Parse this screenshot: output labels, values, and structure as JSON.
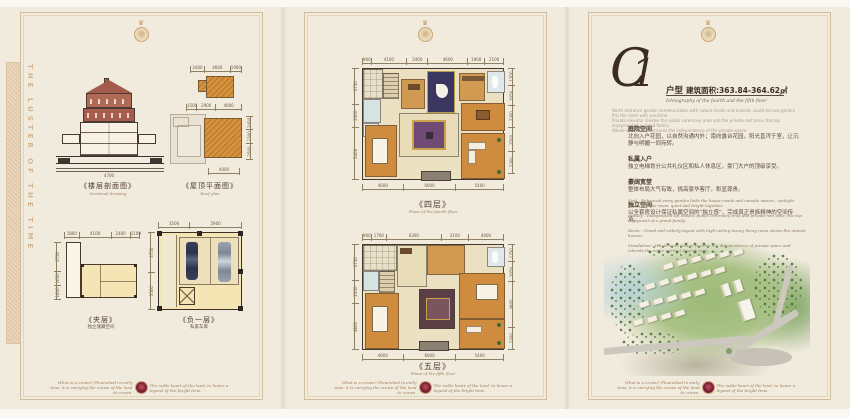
{
  "page": {
    "bg": "#f1ebde",
    "frame_color": "#cfbd9e",
    "seal_color": "#7c1f30",
    "accent_gold": "#c09a66"
  },
  "side_text": "THE LUSTER OF THE TIME",
  "crest": {
    "icon": "crown-icon",
    "glyph": "♛"
  },
  "footer": {
    "left": "What is a crown? Flourished in early time, it is carrying the crown of the land to crown.",
    "right": "The noble heart of the land, to honor a legend of the bright time."
  },
  "left": {
    "section": {
      "label": "《楼层剖面图》",
      "sub": "Sectional drawing",
      "dim_bottom": "4700"
    },
    "roof": {
      "label": "《屋顶平面图》",
      "sub": "Roof plan",
      "dims_top": [
        "2400",
        "4600",
        "1900"
      ],
      "dims_mid": [
        "1500",
        "2900",
        "4000"
      ],
      "dims_right": [
        "2050",
        "2300",
        "2500"
      ],
      "dims_bottom": [
        "4000"
      ]
    },
    "mezzanine": {
      "label": "《夹层》",
      "sub": "独立储藏空间",
      "dims_top": [
        "1800",
        "4100",
        "2400",
        "1100"
      ],
      "dims_left": [
        "3750",
        "1650",
        "1800"
      ]
    },
    "basement": {
      "label": "《负一层》",
      "sub": "私家车库",
      "dims_top": [
        "3500",
        "5900"
      ],
      "dims_left": [
        "3750",
        "3500"
      ]
    }
  },
  "middle": {
    "floor4": {
      "label": "《四层》",
      "sub": "Plane of the fourth floor",
      "dims_top": [
        "900",
        "4100",
        "2400",
        "4600",
        "1900",
        "2100"
      ],
      "dims_left": [
        "3750",
        "2300",
        "5400"
      ],
      "dims_right": [
        "1700",
        "2050",
        "2300",
        "2500",
        "2300"
      ],
      "dims_bottom": [
        "4600",
        "6000",
        "5400"
      ]
    },
    "floor5": {
      "label": "《五层》",
      "sub": "Plane of the fifth floor",
      "dims_top": [
        "900",
        "1700",
        "6300",
        "3100",
        "4000"
      ],
      "dims_left": [
        "3750",
        "2300",
        "4800"
      ],
      "dims_right": [
        "1750",
        "2050",
        "4800",
        "2300"
      ],
      "dims_bottom": [
        "4600",
        "6000",
        "5400"
      ]
    }
  },
  "right": {
    "logo": "C1",
    "logo_c": "C",
    "logo_one": "1",
    "type_label": "户型",
    "area": "建筑面积:363.84-364.62㎡",
    "subtitle": "Ichnography of the fourth and the fifth floor",
    "fine_print": [
      "North entrance garden communicates with nature inside and outside, south terrace garden fills the room with sunshine.",
      "Private elevator divides the public ceremony area and the private rest area, the top enjoyment of a grand family.",
      "Whole-suite design ensures the independence of the private space."
    ],
    "paragraphs": [
      {
        "head": "庭院空间",
        "body": "北向入户花园，以自然沟通内外；南向露台花园，阳光直泻于室，让沉静与明媚一同宛转。"
      },
      {
        "head": "私属入户",
        "body": "独立电梯划分公共礼仪区和私人休息区，豪门大户的顶级享受。"
      },
      {
        "head": "豪阔宽堂",
        "body": "整体布局大气有致，挑高豪华客厅，彰显尊贵。"
      },
      {
        "head": "独立空间",
        "body": "以全套房设计保证私属空间的“独立感”，完成真正贵族精神的空间传承。"
      }
    ],
    "en_lines": [
      "Yard : Enhanced entry garden links the house inside and outside nature ; sunlight pours into the room, quiet and bright together.",
      "Privacy : Independent lift divides public ceremony area and private rest zone, the top enjoyment of a grand family.",
      "Room : Grand and orderly layout with high-ceiling luxury living room shows the utmost honour.",
      "Standalone : Whole-suite design ensures the independence of private space and inherits the noble spirit of English style."
    ]
  }
}
